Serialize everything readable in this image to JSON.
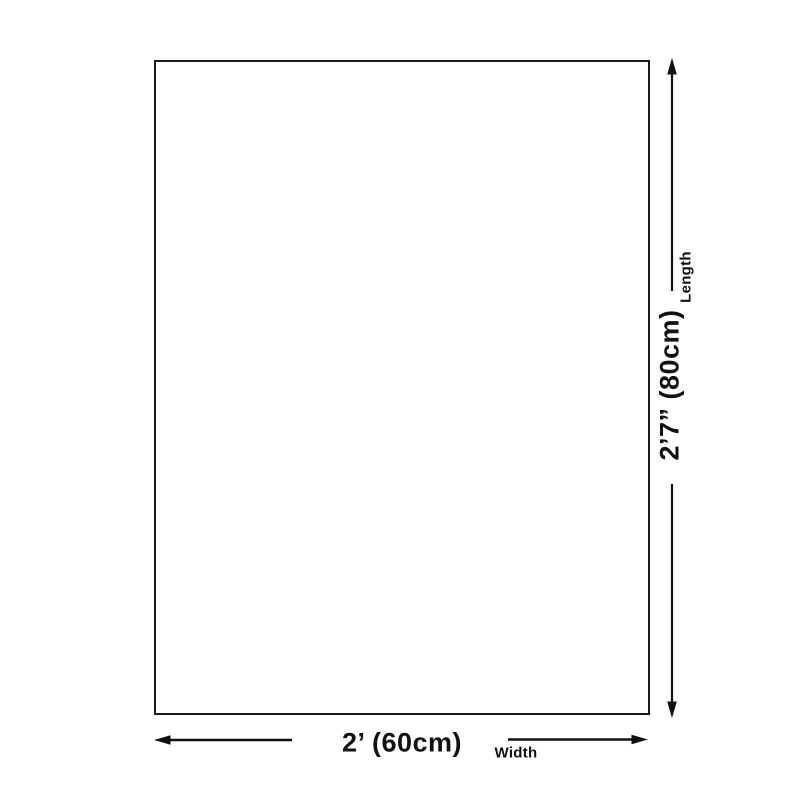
{
  "colors": {
    "background": "#ffffff",
    "outline": "#1a1a1a",
    "arrow": "#111111",
    "text": "#111111"
  },
  "diagram": {
    "kind": "product-dimension-diagram",
    "dimensions": {
      "length": {
        "label": "Length",
        "value": "2’7” (80cm)"
      },
      "width": {
        "label": "Width",
        "value": "2’ (60cm)"
      }
    }
  }
}
